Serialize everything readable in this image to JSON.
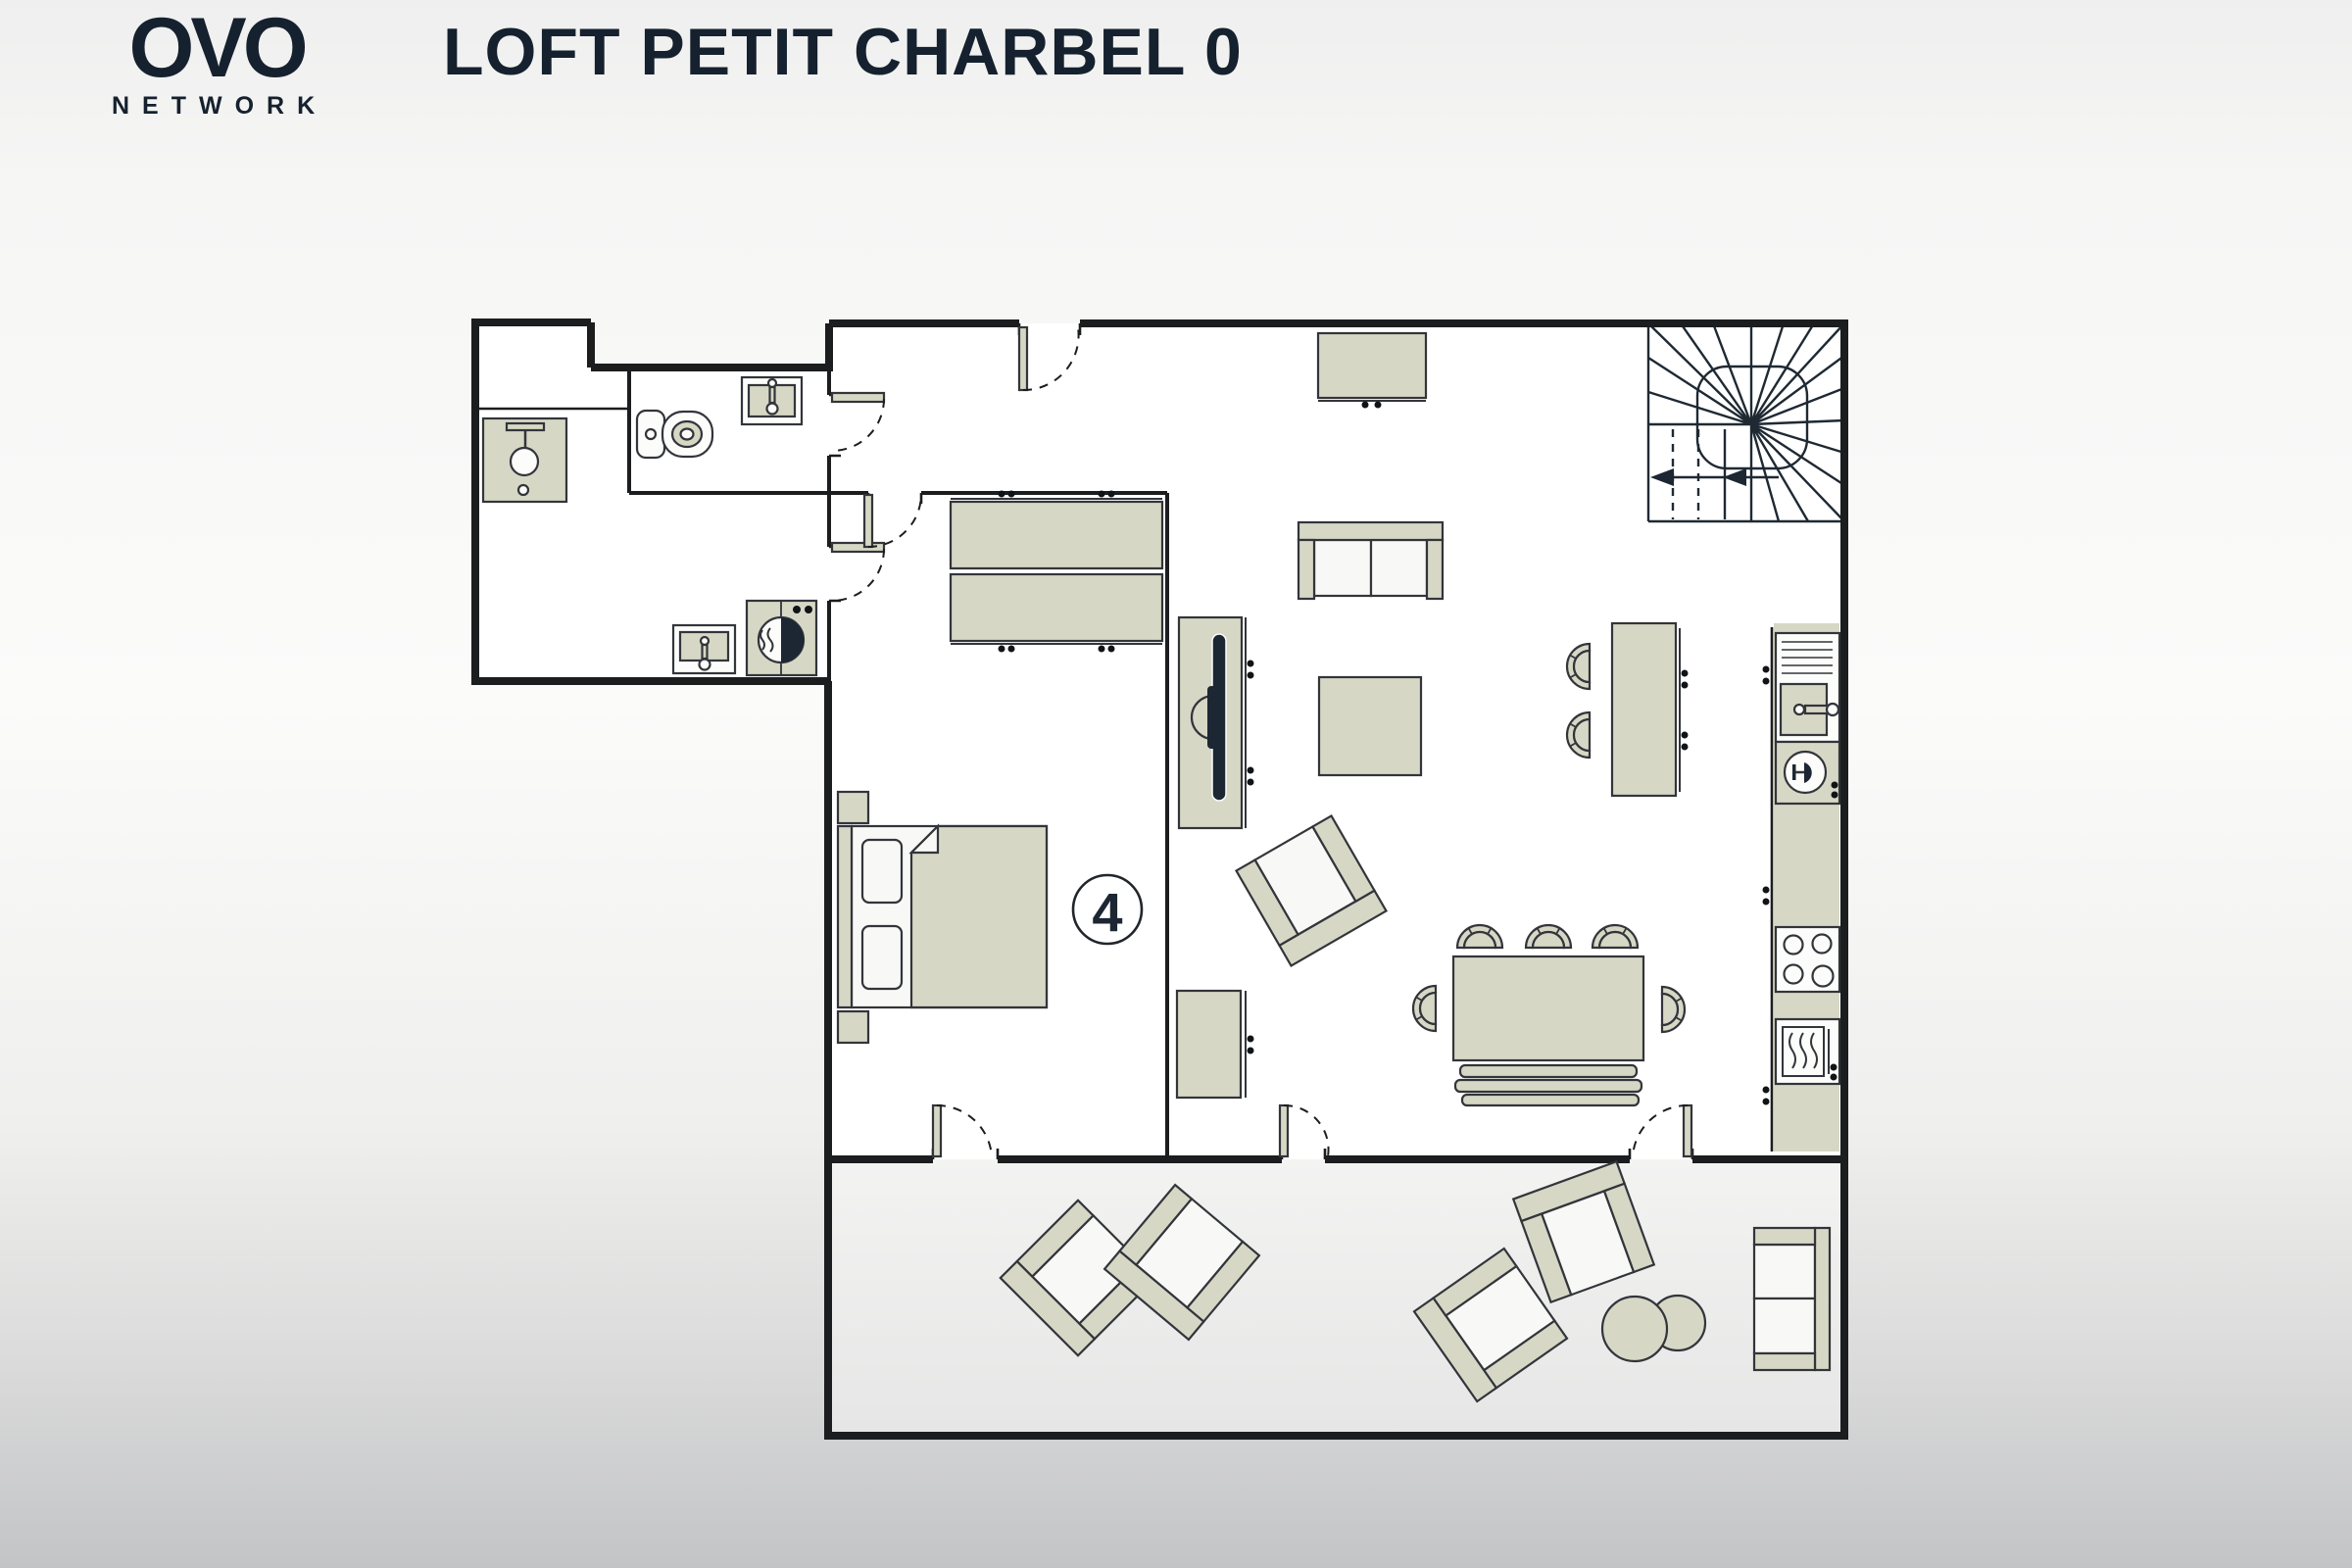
{
  "header": {
    "logo": {
      "text": "OVO",
      "subtext": "NETWORK"
    },
    "title": "LOFT PETIT CHARBEL 0"
  },
  "plan": {
    "capacity_badge": "4",
    "rooms": [
      {
        "id": "wc",
        "furniture": [
          "toilet",
          "washbasin"
        ]
      },
      {
        "id": "shower-room",
        "furniture": [
          "shower"
        ]
      },
      {
        "id": "laundry",
        "furniture": [
          "laundry-sink",
          "washing-machine"
        ]
      },
      {
        "id": "hallway",
        "furniture": [
          "entry-door"
        ]
      },
      {
        "id": "bedroom",
        "capacity": "4",
        "furniture": [
          "double-bed",
          "nightstand",
          "nightstand",
          "wardrobe"
        ]
      },
      {
        "id": "living-room",
        "furniture": [
          "sideboard",
          "sofa",
          "coffee-table",
          "armchair",
          "tv",
          "tv-bench",
          "desk"
        ]
      },
      {
        "id": "kitchen",
        "furniture": [
          "fridge",
          "kitchen-sink",
          "dishwasher",
          "hob",
          "oven",
          "bar-table",
          "bar-stool",
          "bar-stool"
        ]
      },
      {
        "id": "dining-area",
        "furniture": [
          "dining-table",
          "dining-chair",
          "dining-chair",
          "dining-chair",
          "dining-chair",
          "dining-chair",
          "bench"
        ]
      },
      {
        "id": "staircase",
        "furniture": [
          "winder-staircase",
          "direction-arrow"
        ]
      },
      {
        "id": "terrace",
        "furniture": [
          "outdoor-armchair",
          "outdoor-armchair",
          "outdoor-armchair",
          "outdoor-armchair",
          "pouf",
          "pouf",
          "outdoor-sofa"
        ]
      }
    ]
  },
  "colors": {
    "furniture_fill": "#d6d7c5",
    "wall": "#1b1d1f",
    "accent_dark": "#1c2733",
    "floor": "#ffffff",
    "terrace_floor": "#ededee",
    "page_top": "#efefef",
    "page_bottom": "#c3c4c6"
  }
}
